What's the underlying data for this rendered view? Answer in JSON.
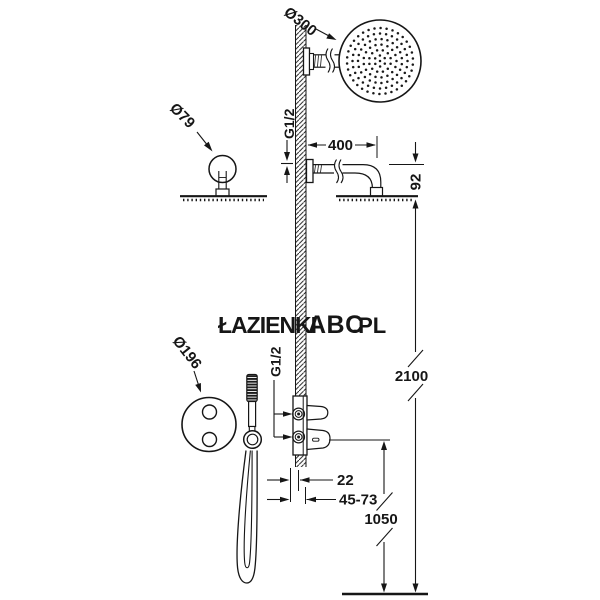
{
  "watermark": {
    "prefix": "ŁAZIENKI",
    "brand": "ABC",
    "suffix": ".PL",
    "brand_color": "#a3ca52",
    "muted_color": "#ececec"
  },
  "drawing": {
    "overhead_shower": {
      "diameter_label": "Ø300",
      "side_diameter_label": "Ø79",
      "arm_thread": "G1/2",
      "arm_length": "400",
      "head_drop": "92"
    },
    "valve": {
      "trim_diameter_label": "Ø196",
      "thread": "G1/2",
      "recess_offset": "22",
      "recess_range": "45-73"
    },
    "heights": {
      "head_height": "2100",
      "valve_height": "1050"
    }
  }
}
